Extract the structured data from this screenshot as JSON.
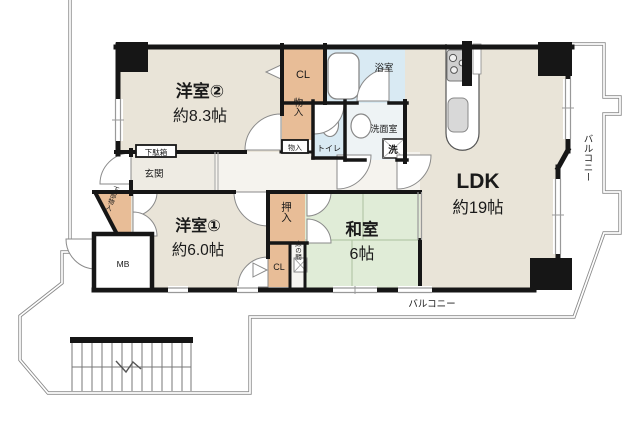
{
  "plan_type": "floorplan",
  "rooms": {
    "western2": {
      "name": "洋室②",
      "size": "約8.3帖"
    },
    "western1": {
      "name": "洋室①",
      "size": "約6.0帖"
    },
    "washitsu": {
      "name": "和室",
      "size": "6帖"
    },
    "ldk": {
      "name": "LDK",
      "size": "約19帖"
    }
  },
  "labels": {
    "cl_top": "CL",
    "storage_top": "物入",
    "storage_small": "物入",
    "toilet": "トイレ",
    "bath": "浴室",
    "washroom": "洗面室",
    "laundry": "洗",
    "shoe_cabinet": "下駄箱",
    "entrance": "玄関",
    "lower_storage": "下部物入",
    "meter_box": "MB",
    "oshiire": "押入",
    "cl_lower": "CL",
    "tokonoma": "床の間",
    "balcony_right": "バルコニー",
    "balcony_bottom": "バルコニー"
  },
  "colors": {
    "wall": "#161616",
    "floor_beige": "#e9e4d8",
    "floor_tan": "#e8bd97",
    "floor_blue": "#d9eaf3",
    "floor_green": "#e0ecd7",
    "boundary_gray": "#8a8a8a"
  }
}
